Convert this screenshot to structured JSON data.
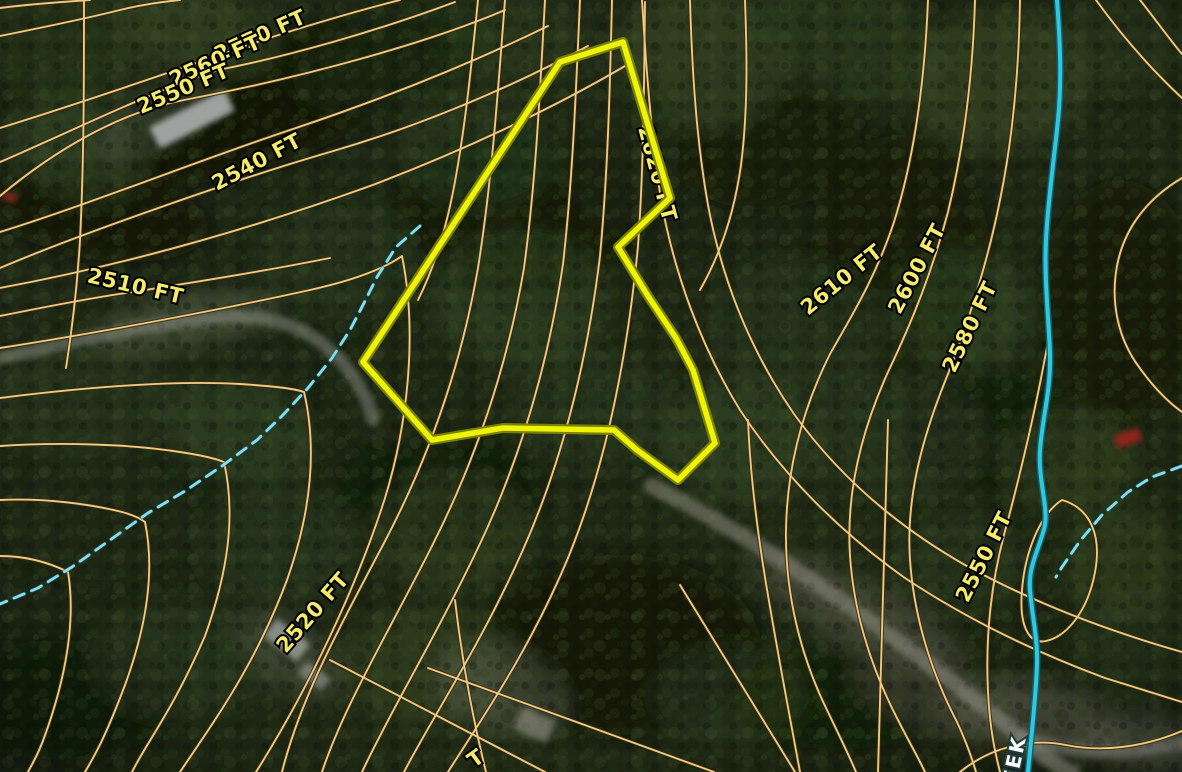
{
  "map_meta": {
    "type": "topographic-parcel-satellite-map",
    "units": "FT",
    "description": "Aerial forest imagery with orange elevation contour lines, a yellow parcel boundary, a creek and intermittent drainage lines"
  },
  "colors": {
    "contour_core": "#ecca82",
    "contour_casing": "#3a2a10",
    "parcel_core": "#eef409",
    "parcel_casing": "#7d8004",
    "creek": "#35c6da",
    "creek_casing": "#0c6073",
    "intermittent_stream": "#8adced",
    "label_fill": "#f4eb6a",
    "label_stroke": "#000000",
    "creek_label_fill": "#ffffff",
    "creek_label_stroke": "#1d3d3d",
    "forest_base": "#1b2513"
  },
  "labels": {
    "elevation": [
      {
        "text": "2570 FT",
        "x": 263,
        "y": 42,
        "rot": -24,
        "anchor": "middle"
      },
      {
        "text": "2560 FT",
        "x": 218,
        "y": 67,
        "rot": -24,
        "anchor": "middle"
      },
      {
        "text": "2550 FT",
        "x": 186,
        "y": 95,
        "rot": -23,
        "anchor": "middle"
      },
      {
        "text": "2540 FT",
        "x": 260,
        "y": 168,
        "rot": -28,
        "anchor": "middle"
      },
      {
        "text": "2510 FT",
        "x": 134,
        "y": 293,
        "rot": 13,
        "anchor": "middle"
      },
      {
        "text": "2620 FT",
        "x": 638,
        "y": 128,
        "rot": 75,
        "anchor": "start"
      },
      {
        "text": "2610 FT",
        "x": 846,
        "y": 285,
        "rot": -39,
        "anchor": "middle"
      },
      {
        "text": "2600 FT",
        "x": 923,
        "y": 272,
        "rot": -62,
        "anchor": "middle"
      },
      {
        "text": "2580 FT",
        "x": 976,
        "y": 330,
        "rot": -64,
        "anchor": "middle"
      },
      {
        "text": "2550 FT",
        "x": 990,
        "y": 560,
        "rot": -63,
        "anchor": "middle"
      },
      {
        "text": "2520 FT",
        "x": 318,
        "y": 617,
        "rot": -49,
        "anchor": "middle"
      }
    ],
    "elevation_partial": {
      "text": "T",
      "x": 480,
      "y": 764,
      "rot": -36,
      "anchor": "middle"
    },
    "creek_partial": {
      "text": "EEK",
      "x": 1016,
      "y": 785,
      "rot": -78,
      "anchor": "start"
    }
  },
  "parcel": {
    "points": "560,62 623,42 670,198 618,247 648,296 676,338 693,370 715,443 678,480 637,450 614,430 503,428 432,440 363,362"
  },
  "contours": [
    "M 0 36 C 40 28 80 20 120 10 C 140 5 160 2 180 0",
    "M 0 8 C 30 4 60 2 90 0",
    "M 400 0 C 345 14 300 28 263 40 C 200 62 90 100 0 128",
    "M 455 2 C 380 30 290 56 218 70 C 150 92 70 132 0 162",
    "M 505 10 C 430 42 310 76 184 100 C 120 112 55 150 0 196",
    "M 548 26 C 470 64 380 100 290 130 C 200 160 90 204 0 232",
    "M 588 46 C 510 88 420 126 330 152 C 240 178 80 234 0 268",
    "M 625 66 C 550 110 460 152 370 186 C 270 222 140 262 0 288",
    "M 330 258 C 260 272 195 282 133 292 C 90 298 40 308 0 316",
    "M 84 0 C 84 80 84 160 80 240 C 77 290 72 330 66 368",
    "M 0 348 C 90 334 210 312 310 290 C 355 280 385 268 402 256 C 417 330 409 420 385 498 C 357 586 309 688 256 772",
    "M 0 398 C 80 388 170 380 240 384 C 270 386 292 388 304 392 C 318 452 310 515 287 580 C 254 668 212 724 180 772",
    "M 0 446 C 60 442 130 444 180 452 C 200 455 214 458 224 462 C 236 515 228 572 205 636 C 172 712 148 740 132 772",
    "M 0 500 C 45 498 90 504 122 512 C 133 515 140 518 145 522 C 155 570 147 625 125 685 C 105 738 95 755 85 772",
    "M 0 556 C 25 556 48 562 68 572 C 76 620 66 678 44 738 C 38 755 32 764 28 772",
    "M 478 0 C 472 60 466 120 456 176 C 448 222 436 264 418 300",
    "M 505 0 C 498 90 492 180 478 268 C 462 360 432 452 384 543 C 336 634 300 700 282 772",
    "M 545 0 C 540 90 536 180 524 268 C 508 362 478 455 432 546 C 386 637 344 706 322 772",
    "M 580 0 C 576 88 573 176 563 264 C 549 358 522 456 478 548 C 434 640 390 712 362 772",
    "M 612 0 C 610 85 608 170 600 256 C 588 354 564 458 522 552 C 480 646 432 718 404 772",
    "M 645 2 C 644 80 644 162 638 246 C 628 350 608 460 568 558 C 528 654 478 724 448 772",
    "M 642 0 C 646 65 651 135 661 200 C 674 272 700 345 740 410 C 782 474 840 532 905 578 C 965 618 1035 652 1105 678 L 1182 702",
    "M 690 0 C 692 68 696 138 708 205 C 722 280 750 350 794 414 C 840 478 900 528 965 565 C 1030 601 1105 630 1182 652",
    "M 745 0 C 747 55 748 110 741 165 C 734 215 720 255 700 290",
    "M 928 0 C 925 75 916 152 894 222 C 876 276 854 312 830 354 C 802 410 787 468 786 530 C 785 592 800 655 827 710 C 838 733 848 753 856 772",
    "M 975 0 C 973 70 965 142 948 212 C 932 272 912 322 888 372 C 860 434 846 495 850 556 C 854 614 872 670 898 720 C 908 740 918 757 925 772",
    "M 1020 0 C 1019 65 1014 132 1000 200 C 988 260 970 318 948 374 C 920 442 906 502 910 560 C 914 618 932 674 957 722 C 964 737 971 755 976 772",
    "M 1050 330 C 1038 400 1022 468 1004 535 C 992 580 985 635 988 692 C 990 730 995 752 1000 772",
    "M 1096 0 C 1122 36 1152 70 1182 98",
    "M 1140 0 C 1156 20 1170 40 1182 54",
    "M 1182 178 C 1148 198 1124 228 1117 266 C 1110 304 1119 340 1139 367 C 1154 388 1168 402 1182 412",
    "M 1062 500 C 1090 508 1102 535 1095 572 C 1088 610 1068 636 1046 641 C 1028 645 1019 624 1022 590 C 1025 552 1040 514 1062 500 Z",
    "M 330 660 L 545 772",
    "M 428 668 L 714 772",
    "M 680 585 L 795 772",
    "M 888 420 L 878 772",
    "M 748 420 C 752 520 770 610 800 772",
    "M 960 772 C 992 746 1032 738 1066 745 C 1100 752 1142 748 1182 731",
    "M 455 600 C 462 660 472 716 486 772"
  ],
  "streams": {
    "creek": "M 1057 0 C 1060 40 1062 80 1058 120 C 1054 160 1048 200 1046 240 C 1044 280 1049 320 1050 355 C 1051 390 1042 420 1040 450 C 1038 480 1048 505 1045 525 C 1040 548 1028 565 1030 590 C 1032 615 1038 640 1037 665 C 1036 695 1032 730 1028 772",
    "intermittent": [
      "M 420 226 L 396 247 L 377 277 L 362 307 L 350 330 L 332 358 L 308 388 L 282 416 L 257 440 L 222 466 L 185 491 L 148 513 L 110 540 L 72 567 L 38 588 L 0 604",
      "M 1182 466 L 1152 477 L 1128 492 L 1102 515 L 1080 541 L 1062 567 L 1056 577"
    ]
  },
  "roads": [
    {
      "d": "M 0 358 C 70 342 140 326 210 318 C 262 313 302 323 333 353 C 356 376 368 398 373 420",
      "w": 13,
      "c": "#8d8f85",
      "o": 0.5
    },
    {
      "d": "M 652 486 C 718 519 790 564 860 614 C 921 657 976 700 1021 737 C 1047 759 1062 770 1072 772",
      "w": 16,
      "c": "#97948a",
      "o": 0.5
    },
    {
      "d": "M 1021 737 C 1066 752 1121 757 1182 743",
      "w": 13,
      "c": "#8f8c82",
      "o": 0.45
    }
  ],
  "structures": {
    "roofs": [
      {
        "x": 192,
        "y": 119,
        "w": 84,
        "h": 24,
        "r": -27,
        "c": "#a8adab",
        "o": 0.92
      },
      {
        "x": 287,
        "y": 640,
        "w": 42,
        "h": 22,
        "r": 38,
        "c": "#9aa098",
        "o": 0.8
      },
      {
        "x": 314,
        "y": 676,
        "w": 30,
        "h": 16,
        "r": 38,
        "c": "#8a9088",
        "o": 0.7
      },
      {
        "x": 535,
        "y": 725,
        "w": 36,
        "h": 24,
        "r": 25,
        "c": "#8f9086",
        "o": 0.6
      }
    ],
    "vehicles": [
      {
        "x": 1128,
        "y": 438,
        "w": 26,
        "h": 14,
        "r": -18,
        "c": "#8f231a",
        "o": 0.95
      },
      {
        "x": 10,
        "y": 197,
        "w": 15,
        "h": 9,
        "r": 12,
        "c": "#7e2a1c",
        "o": 0.9
      }
    ]
  },
  "forest_blobs": [
    [
      280,
      100,
      170,
      60,
      -22,
      "#0a0f06",
      0.75
    ],
    [
      100,
      215,
      110,
      45,
      8,
      "#0a0f06",
      0.7
    ],
    [
      520,
      210,
      120,
      90,
      0,
      "#0c1107",
      0.6
    ],
    [
      40,
      60,
      85,
      50,
      0,
      "#0b1007",
      0.65
    ],
    [
      760,
      130,
      100,
      80,
      0,
      "#0d1308",
      0.5
    ],
    [
      900,
      255,
      90,
      120,
      0,
      "#0d1208",
      0.55
    ],
    [
      1120,
      300,
      80,
      120,
      0,
      "#0b1007",
      0.6
    ],
    [
      620,
      645,
      140,
      90,
      0,
      "#0a0f06",
      0.7
    ],
    [
      440,
      490,
      100,
      55,
      0,
      "#0c1107",
      0.5
    ],
    [
      990,
      430,
      90,
      60,
      0,
      "#0b1007",
      0.5
    ],
    [
      60,
      700,
      120,
      60,
      0,
      "#0b1007",
      0.5
    ],
    [
      840,
      700,
      110,
      50,
      0,
      "#0c1107",
      0.45
    ],
    [
      60,
      40,
      90,
      60,
      0,
      "#2c3d1e",
      0.7
    ],
    [
      200,
      30,
      80,
      40,
      20,
      "#3a4d27",
      0.6
    ],
    [
      390,
      60,
      100,
      50,
      -15,
      "#1f2c15",
      0.7
    ],
    [
      520,
      40,
      70,
      45,
      10,
      "#2c3d1e",
      0.6
    ],
    [
      700,
      60,
      90,
      70,
      0,
      "#3a4d27",
      0.6
    ],
    [
      850,
      40,
      100,
      60,
      15,
      "#2c3d1e",
      0.65
    ],
    [
      1000,
      80,
      90,
      70,
      -10,
      "#3a4d27",
      0.6
    ],
    [
      1120,
      40,
      70,
      50,
      0,
      "#2c3d1e",
      0.6
    ],
    [
      80,
      150,
      70,
      50,
      25,
      "#3a4d27",
      0.5
    ],
    [
      480,
      150,
      80,
      60,
      0,
      "#2c3d1e",
      0.6
    ],
    [
      620,
      150,
      60,
      80,
      0,
      "#1f2c15",
      0.55
    ],
    [
      340,
      260,
      80,
      60,
      0,
      "#2c3d1e",
      0.55
    ],
    [
      520,
      300,
      90,
      70,
      0,
      "#3a4d27",
      0.5
    ],
    [
      660,
      310,
      70,
      60,
      0,
      "#1f2c15",
      0.55
    ],
    [
      800,
      330,
      90,
      70,
      10,
      "#2c3d1e",
      0.55
    ],
    [
      960,
      310,
      70,
      60,
      0,
      "#3a4d27",
      0.5
    ],
    [
      80,
      400,
      90,
      60,
      0,
      "#2c3d1e",
      0.55
    ],
    [
      240,
      430,
      80,
      50,
      15,
      "#3a4d27",
      0.5
    ],
    [
      420,
      390,
      90,
      60,
      0,
      "#1f2c15",
      0.55
    ],
    [
      590,
      410,
      80,
      60,
      0,
      "#2c3d1e",
      0.5
    ],
    [
      740,
      440,
      80,
      60,
      0,
      "#3a4d27",
      0.5
    ],
    [
      900,
      440,
      90,
      60,
      0,
      "#2c3d1e",
      0.5
    ],
    [
      1070,
      460,
      70,
      50,
      0,
      "#3a4d27",
      0.45
    ],
    [
      100,
      520,
      90,
      60,
      0,
      "#1f2c15",
      0.55
    ],
    [
      280,
      545,
      80,
      60,
      0,
      "#2c3d1e",
      0.5
    ],
    [
      450,
      530,
      80,
      60,
      0,
      "#3a4d27",
      0.45
    ],
    [
      960,
      565,
      70,
      50,
      0,
      "#2c3d1e",
      0.5
    ],
    [
      1120,
      565,
      60,
      60,
      0,
      "#3a4d27",
      0.45
    ],
    [
      180,
      660,
      90,
      60,
      0,
      "#2c3d1e",
      0.5
    ],
    [
      430,
      665,
      90,
      60,
      0,
      "#3a4d27",
      0.45
    ],
    [
      730,
      695,
      80,
      50,
      0,
      "#2c3d1e",
      0.5
    ],
    [
      1140,
      650,
      70,
      60,
      0,
      "#2c3d1e",
      0.5
    ],
    [
      185,
      322,
      95,
      26,
      -10,
      "#5f6650",
      0.55
    ],
    [
      860,
      615,
      120,
      33,
      28,
      "#6a675a",
      0.45
    ],
    [
      500,
      690,
      70,
      42,
      20,
      "#70705f",
      0.4
    ],
    [
      1030,
      718,
      90,
      38,
      10,
      "#6b695c",
      0.5
    ],
    [
      155,
      120,
      70,
      26,
      -27,
      "#4a5140",
      0.5
    ],
    [
      290,
      655,
      60,
      33,
      38,
      "#5a6050",
      0.45
    ],
    [
      1150,
      745,
      70,
      28,
      5,
      "#6f6d60",
      0.55
    ],
    [
      930,
      700,
      80,
      30,
      20,
      "#5d5b4c",
      0.4
    ]
  ]
}
